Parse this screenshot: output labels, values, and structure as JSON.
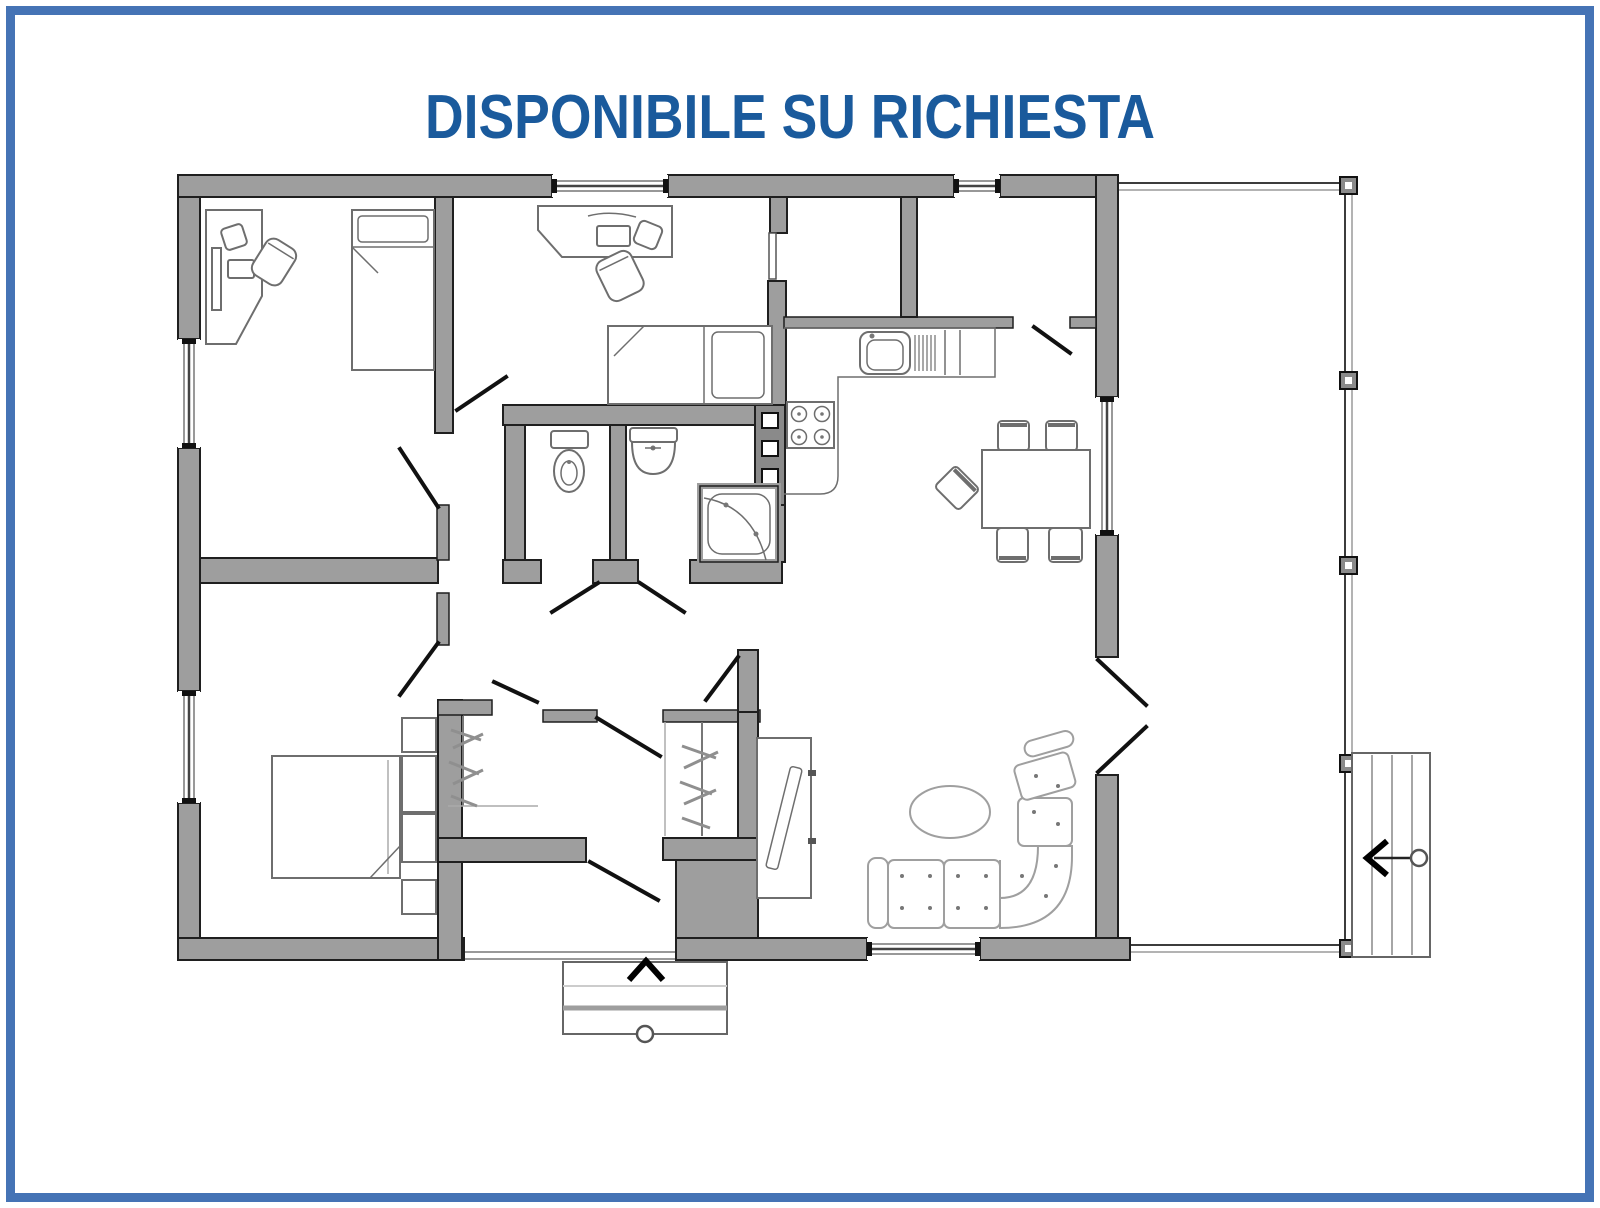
{
  "frame": {
    "color": "#4573b5"
  },
  "title": {
    "text": "DISPONIBILE SU RICHIESTA",
    "color": "#1a5a9c"
  },
  "plan": {
    "wall_color": "#9e9e9e",
    "wall_outline": "#1f1f1f",
    "furniture_outline": "#6e6e6e",
    "rooms": [
      "bedroom-top-left",
      "bedroom-top-middle",
      "wc-room",
      "shower-room",
      "kitchen",
      "dining-area",
      "living-room",
      "master-bedroom",
      "hallway",
      "closet-left",
      "closet-right",
      "utility-room",
      "entry-vestibule",
      "terrace"
    ],
    "symbols": [
      "corner-desk",
      "office-chair",
      "single-bed",
      "double-bed",
      "wardrobe-column",
      "clothes-rail",
      "toilet",
      "washbasin",
      "shower-cabin",
      "kitchen-sink",
      "dish-drainer",
      "stove-4-burners",
      "service-shaft",
      "dining-table",
      "dining-chair",
      "corner-sofa",
      "coffee-table",
      "tv-cabinet",
      "window",
      "door-swing",
      "french-door",
      "terrace-post",
      "outdoor-steps",
      "entry-steps",
      "direction-arrow"
    ]
  }
}
